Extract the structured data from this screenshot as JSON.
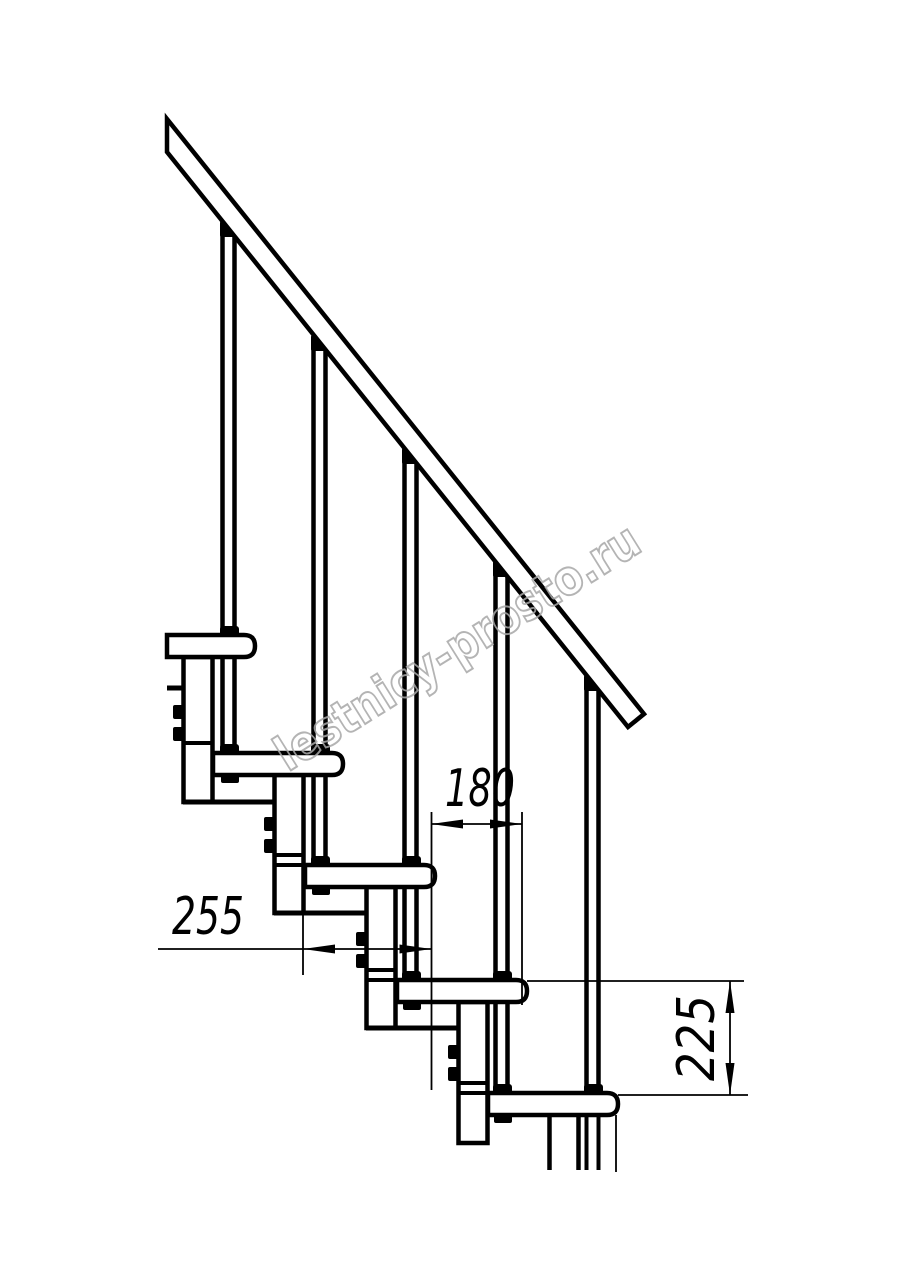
{
  "drawing": {
    "watermark": "lestnicy-prosto.ru",
    "dimension_run": "180",
    "dimension_depth": "255",
    "dimension_rise": "225",
    "colors": {
      "line": "#000000",
      "watermark_outline": "#a8a8a8",
      "background": "#ffffff"
    }
  }
}
